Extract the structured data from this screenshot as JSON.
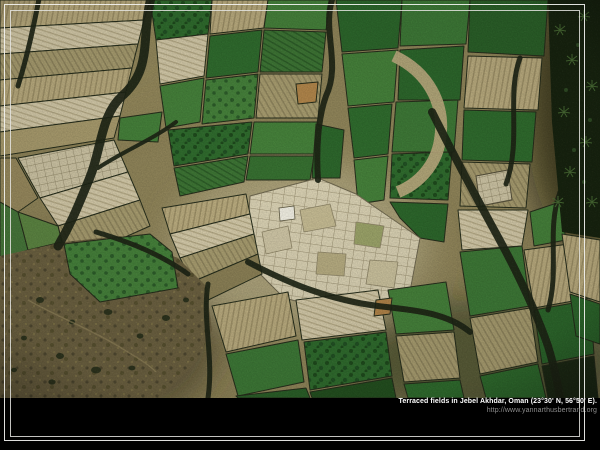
{
  "caption": {
    "title": "Terraced fields in Jebel Akhdar, Oman (23°30' N, 56°50' E).",
    "url": "http://www.yannarthusbertrand.org"
  },
  "photo": {
    "subject": "aerial-view-of-terraced-fields-patchwork"
  },
  "colors": {
    "background": "#000000",
    "frame_line": "#eeeeec",
    "caption_title": "#ffffff",
    "caption_url": "#8d8d8d",
    "field_green_dark": "#2c662b",
    "field_green": "#3d7836",
    "field_green_light": "#45803a",
    "field_cream": "#d6cdae",
    "field_tan": "#b9ab7e",
    "field_khaki": "#a79c6f",
    "terrace_shadow": "#1d2415",
    "scrubland": "#6b6040",
    "palm_canopy": "#17230f",
    "building_white": "#eeece0"
  }
}
